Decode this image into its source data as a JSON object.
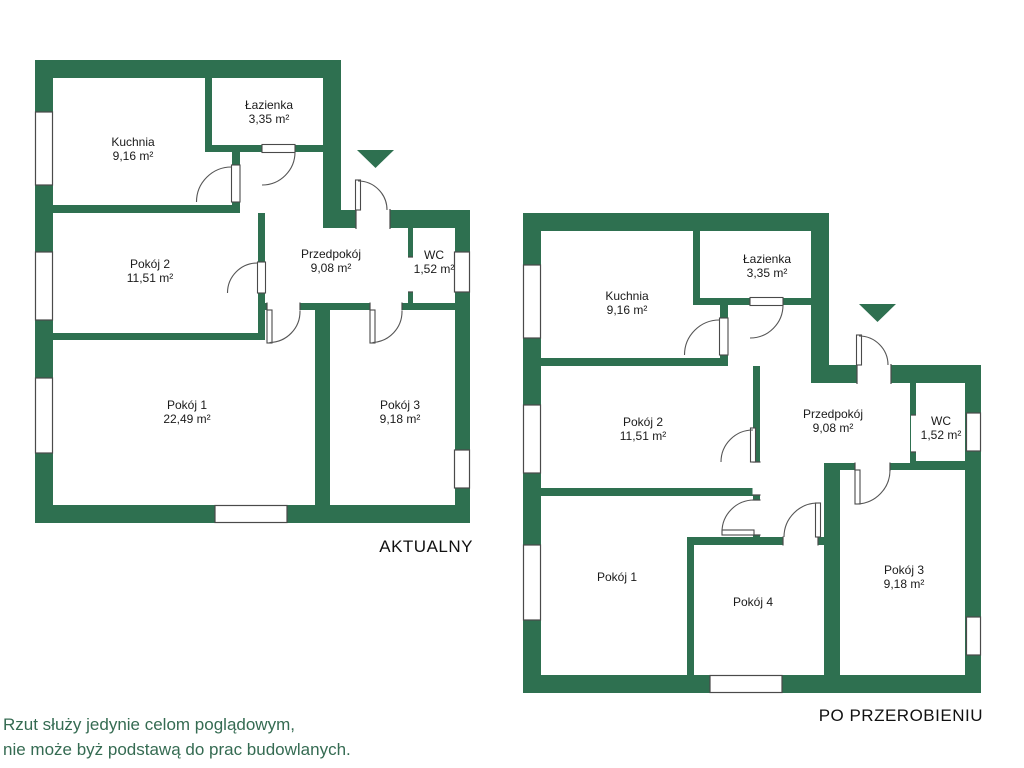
{
  "colors": {
    "wall": "#2E7050",
    "outline": "#4a4a4a",
    "label": "#1a1a1a",
    "note": "#356B52"
  },
  "plans": [
    {
      "title": "AKTUALNY",
      "rooms": [
        {
          "name": "Kuchnia",
          "area": "9,16 m²"
        },
        {
          "name": "Łazienka",
          "area": "3,35 m²"
        },
        {
          "name": "Pokój 2",
          "area": "11,51 m²"
        },
        {
          "name": "Przedpokój",
          "area": "9,08 m²"
        },
        {
          "name": "WC",
          "area": "1,52 m²"
        },
        {
          "name": "Pokój 1",
          "area": "22,49 m²"
        },
        {
          "name": "Pokój 3",
          "area": "9,18 m²"
        }
      ]
    },
    {
      "title": "PO PRZEROBIENIU",
      "rooms": [
        {
          "name": "Kuchnia",
          "area": "9,16 m²"
        },
        {
          "name": "Łazienka",
          "area": "3,35 m²"
        },
        {
          "name": "Pokój 2",
          "area": "11,51 m²"
        },
        {
          "name": "Przedpokój",
          "area": "9,08 m²"
        },
        {
          "name": "WC",
          "area": "1,52 m²"
        },
        {
          "name": "Pokój 1",
          "area": ""
        },
        {
          "name": "Pokój 4",
          "area": ""
        },
        {
          "name": "Pokój 3",
          "area": "9,18 m²"
        }
      ]
    }
  ],
  "note": {
    "line1": "Rzut służy jedynie celom poglądowym,",
    "line2": "nie może byż podstawą do prac budowlanych."
  }
}
